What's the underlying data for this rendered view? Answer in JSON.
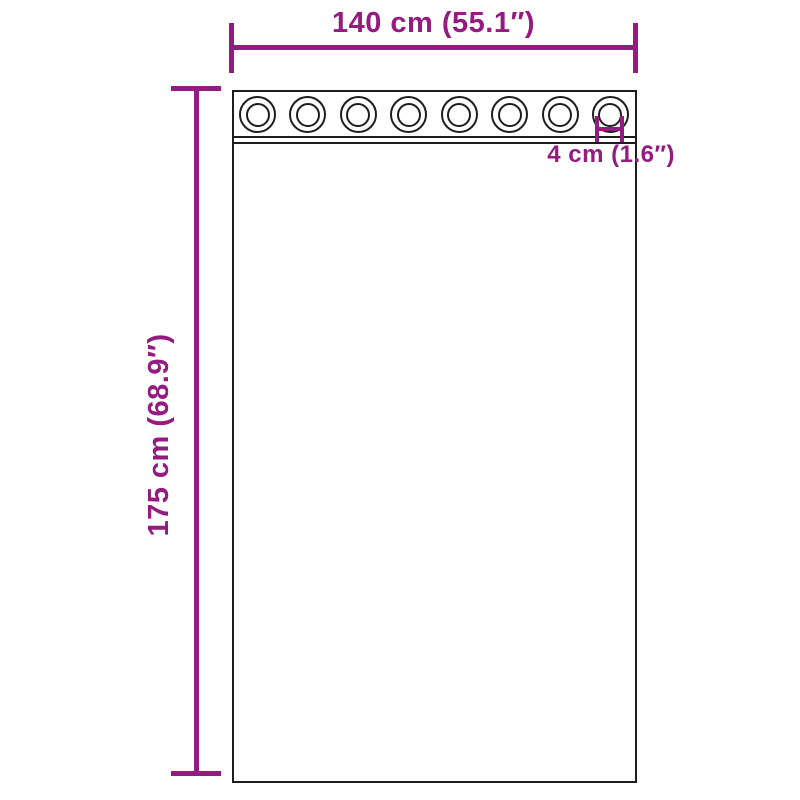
{
  "colors": {
    "dimension": "#951b81",
    "outline": "#1d1d1b",
    "background": "#ffffff"
  },
  "labels": {
    "width": "140 cm (55.1″)",
    "height": "175 cm (68.9″)",
    "grommet_diameter": "4 cm (1.6″)"
  },
  "grommets": {
    "count": 8
  }
}
